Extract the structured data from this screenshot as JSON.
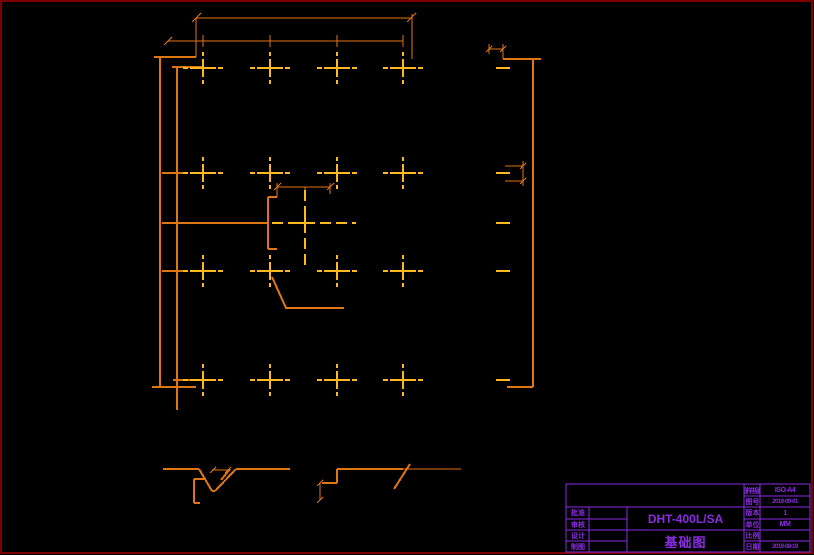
{
  "colors": {
    "bg": "#000000",
    "border": "#7E0000",
    "orange": "#E07514",
    "gold": "#FFB81E",
    "violet": "#8A2BE2"
  },
  "title_block": {
    "sheet_format_label": "图样规格",
    "sheet_format": "ISO-A4",
    "drawing_no_label": "图 号",
    "drawing_no": "2019-09-01",
    "version_label": "版 本",
    "version": "1",
    "unit_label": "单 位",
    "unit": "MM",
    "scale_label": "比 例",
    "scale": "",
    "date_label": "日 期",
    "date": "2019-08-19",
    "approve_label": "批 准",
    "check_label": "审 核",
    "design_label": "设 计",
    "draft_label": "制 图",
    "model": "DHT-400L/SA",
    "drawing_title": "基础图"
  }
}
